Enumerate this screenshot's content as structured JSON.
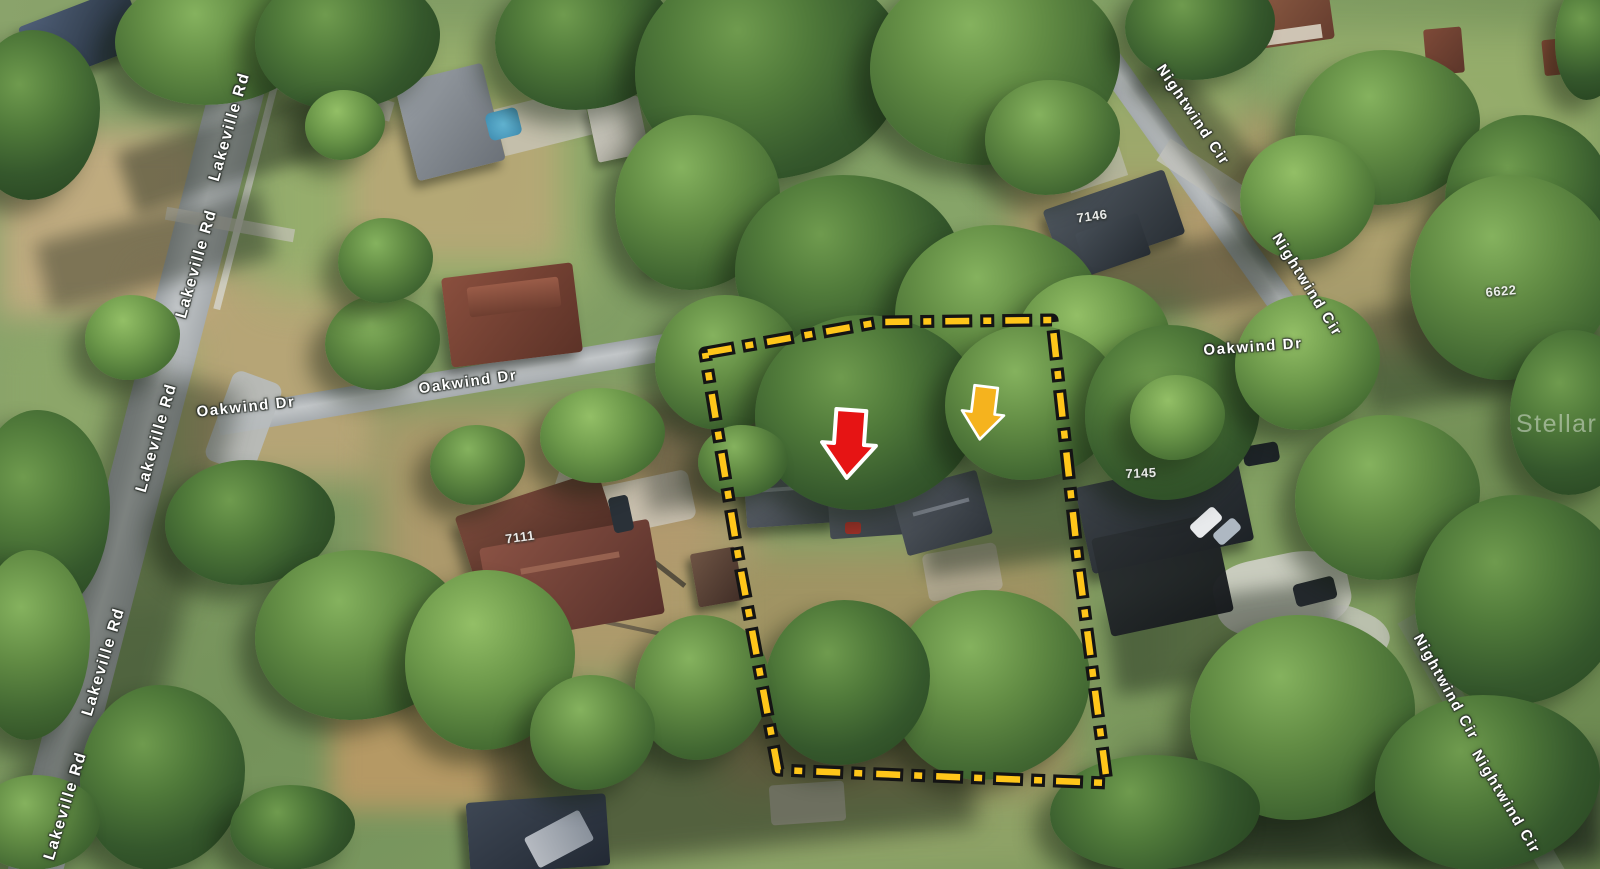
{
  "scene_description": "Aerial 3D satellite photo of residential lots with MLS property annotation",
  "map_labels": {
    "streets": [
      {
        "text": "Lakeville Rd",
        "x": 230,
        "y": 127,
        "rot": -74,
        "size": 16
      },
      {
        "text": "Lakeville Rd",
        "x": 197,
        "y": 264,
        "rot": -74,
        "size": 16
      },
      {
        "text": "Lakeville Rd",
        "x": 157,
        "y": 438,
        "rot": -74,
        "size": 16
      },
      {
        "text": "Lakeville Rd",
        "x": 104,
        "y": 662,
        "rot": -73,
        "size": 16
      },
      {
        "text": "Lakeville Rd",
        "x": 66,
        "y": 806,
        "rot": -73,
        "size": 16
      },
      {
        "text": "Oakwind Dr",
        "x": 246,
        "y": 407,
        "rot": -6,
        "size": 15
      },
      {
        "text": "Oakwind Dr",
        "x": 468,
        "y": 382,
        "rot": -8,
        "size": 15
      },
      {
        "text": "Oakwind Dr",
        "x": 1253,
        "y": 347,
        "rot": -4,
        "size": 15
      },
      {
        "text": "Nightwind Cir",
        "x": 1193,
        "y": 115,
        "rot": 56,
        "size": 15
      },
      {
        "text": "Nightwind Cir",
        "x": 1307,
        "y": 285,
        "rot": 58,
        "size": 15
      },
      {
        "text": "Nightwind Cir",
        "x": 1446,
        "y": 687,
        "rot": 61,
        "size": 15
      },
      {
        "text": "Nightwind Cir",
        "x": 1506,
        "y": 802,
        "rot": 59,
        "size": 15
      }
    ],
    "addresses": [
      {
        "text": "7146",
        "x": 1092,
        "y": 216,
        "rot": -8
      },
      {
        "text": "6622",
        "x": 1501,
        "y": 291,
        "rot": -5
      },
      {
        "text": "7145",
        "x": 1141,
        "y": 473,
        "rot": -3
      },
      {
        "text": "7111",
        "x": 520,
        "y": 537,
        "rot": -8
      }
    ]
  },
  "annotations": {
    "boundary": {
      "color": "#FFC61A",
      "outline_color": "#141414",
      "path": "M705,353 L880,322 L1052,320 L1078,560 L1107,783 L778,770 L738,555 Z"
    },
    "arrows": [
      {
        "id": "red-arrow",
        "color": "#E61414",
        "outline": "#FFFFFF",
        "x": 849,
        "y": 444,
        "rot": 4,
        "size": 1.0
      },
      {
        "id": "orange-arrow",
        "color": "#F5B31E",
        "outline": "#FFFFFF",
        "x": 983,
        "y": 413,
        "rot": 7,
        "size": 0.78
      }
    ]
  },
  "watermark": {
    "text": "Stellar MLS",
    "x": 1516,
    "y": 410,
    "opacity": 0.42
  }
}
